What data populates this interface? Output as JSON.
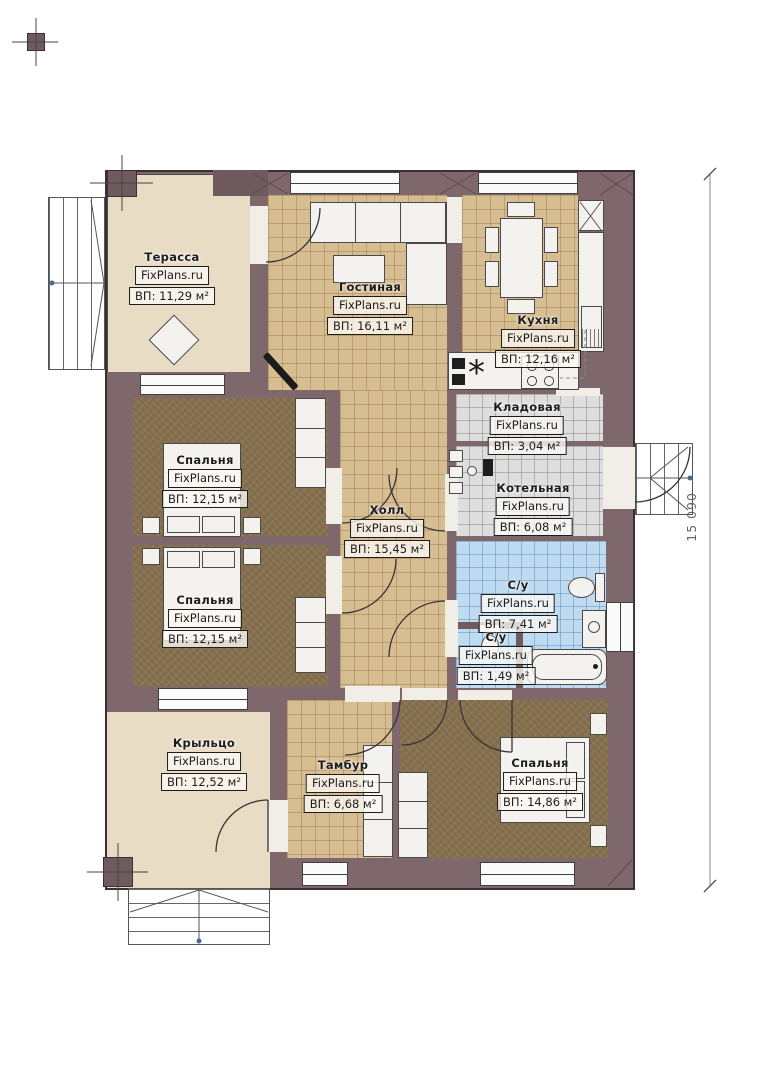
{
  "plan": {
    "source_watermark": "FixPlans.ru",
    "dimension_right": "15 090"
  },
  "icons": {
    "sink_symbol": "*"
  },
  "rooms": {
    "terrace": {
      "name": "Терасса",
      "wm": "FixPlans.ru",
      "area": "ВП: 11,29 м²"
    },
    "living_room": {
      "name": "Гостиная",
      "wm": "FixPlans.ru",
      "area": "ВП: 16,11 м²"
    },
    "kitchen": {
      "name": "Кухня",
      "wm": "FixPlans.ru",
      "area": "ВП: 12,16 м²"
    },
    "pantry": {
      "name": "Кладовая",
      "wm": "FixPlans.ru",
      "area": "ВП: 3,04 м²"
    },
    "boiler_room": {
      "name": "Котельная",
      "wm": "FixPlans.ru",
      "area": "ВП: 6,08 м²"
    },
    "bathroom": {
      "name": "С/у",
      "wm": "FixPlans.ru",
      "area": "ВП: 7,41 м²"
    },
    "wc_small": {
      "name": "С/у",
      "wm": "FixPlans.ru",
      "area": "ВП: 1,49 м²"
    },
    "bedroom_1": {
      "name": "Спальня",
      "wm": "FixPlans.ru",
      "area": "ВП: 12,15 м²"
    },
    "bedroom_2": {
      "name": "Спальня",
      "wm": "FixPlans.ru",
      "area": "ВП: 12,15 м²"
    },
    "hall": {
      "name": "Холл",
      "wm": "FixPlans.ru",
      "area": "ВП: 15,45 м²"
    },
    "porch": {
      "name": "Крыльцо",
      "wm": "FixPlans.ru",
      "area": "ВП: 12,52 м²"
    },
    "vestibule": {
      "name": "Тамбур",
      "wm": "FixPlans.ru",
      "area": "ВП: 6,68 м²"
    },
    "bedroom_3": {
      "name": "Спальня",
      "wm": "FixPlans.ru",
      "area": "ВП: 14,86 м²"
    }
  },
  "colors": {
    "wall": "#7e686c",
    "wall_dark": "#3b3134",
    "floor_tan": "#d7bd92",
    "floor_gray": "#dedede",
    "floor_blue": "#bedbf2",
    "carpet": "#86714f",
    "beige": "#e9dcc5"
  }
}
